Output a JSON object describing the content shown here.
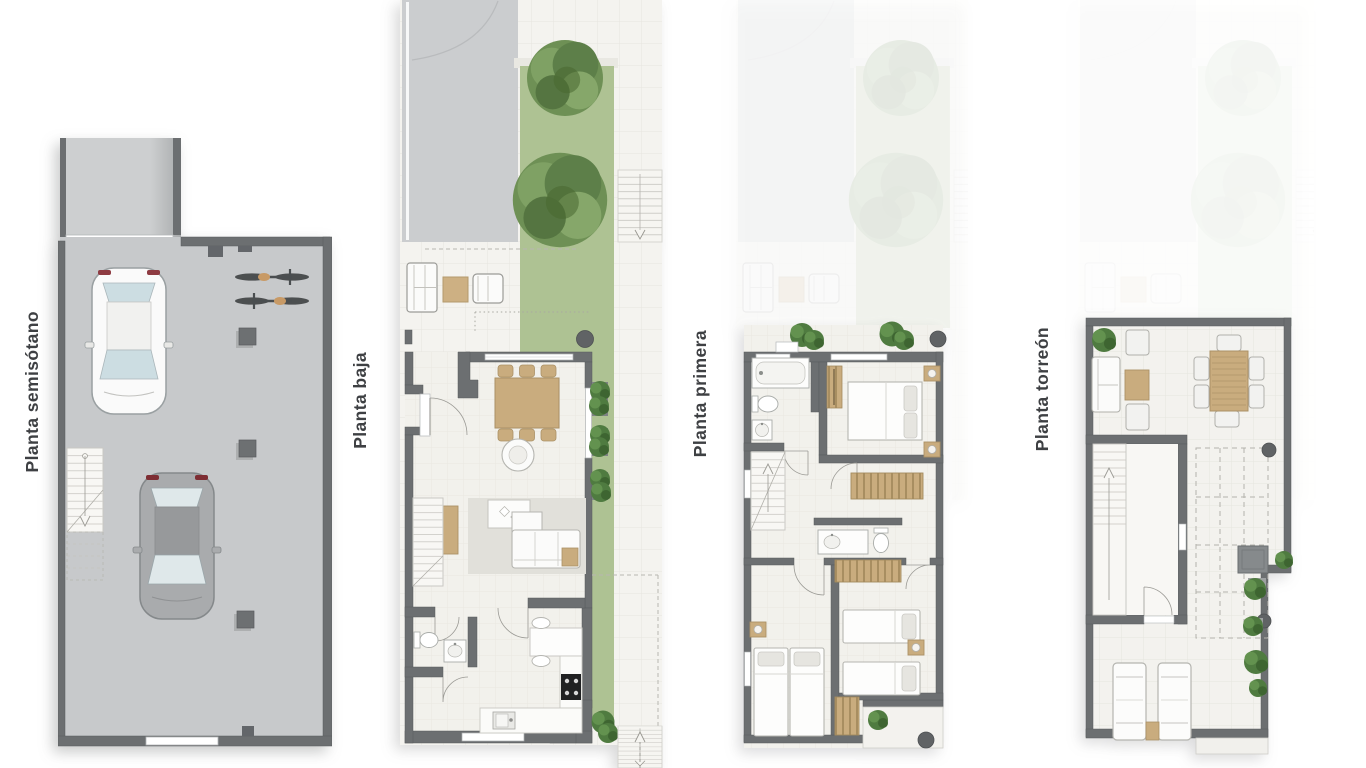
{
  "page": {
    "background": "#ffffff"
  },
  "floors": [
    {
      "id": "semisotano",
      "label": "Planta semisótano",
      "elements": [
        "access-ramp",
        "garage-door",
        "white-car",
        "gray-car",
        "two-bicycles",
        "structural-columns",
        "staircase"
      ]
    },
    {
      "id": "baja",
      "label": "Planta baja",
      "elements": [
        "driveway",
        "lawn-garden",
        "trees",
        "terrace-sofa-set",
        "entry-door",
        "dining-table-six-chairs",
        "armchair",
        "rug",
        "coffee-table",
        "sofa",
        "tv-cabinet",
        "staircase",
        "powder-room",
        "kitchen-island",
        "cooktop",
        "sink",
        "planters",
        "exterior-steps"
      ]
    },
    {
      "id": "primera",
      "label": "Planta primera",
      "elements": [
        "front-terrace",
        "bathtub",
        "toilet",
        "washbasin",
        "wardrobes",
        "double-bed",
        "nightstands",
        "staircase",
        "second-bathroom",
        "twin-bedroom-left",
        "twin-bedroom-right",
        "rear-balcony",
        "planters"
      ]
    },
    {
      "id": "torreon",
      "label": "Planta torreón",
      "elements": [
        "roof-terrace",
        "lounge-set",
        "outdoor-dining-table",
        "staircase-enclosure",
        "pergola-dashed-outline",
        "chimney",
        "planters",
        "sun-loungers"
      ]
    }
  ],
  "colors": {
    "wall": "#6c6f71",
    "concrete": "#c7c9cb",
    "driveway": "#cbcdcf",
    "paving": "#f4f3ef",
    "interior_floor": "#f2f1ec",
    "grass": "#aec293",
    "tree": "#6e9055",
    "wood": "#c9ac7e",
    "white_furniture": "#fbfbfa",
    "plant": "#4f7b40",
    "cooktop": "#202122",
    "label_text": "#3e4043"
  }
}
